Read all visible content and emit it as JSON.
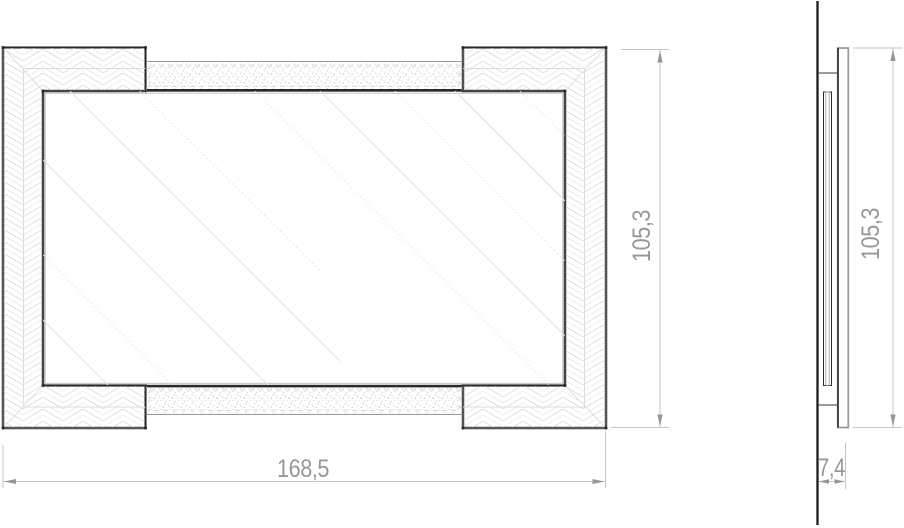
{
  "drawing": {
    "type": "technical-drawing",
    "subject": "framed-mirror",
    "views": {
      "front": {
        "label": "front-elevation",
        "width_dim": "168,5",
        "height_dim": "105,3"
      },
      "side": {
        "label": "side-profile",
        "height_dim": "105,3",
        "depth_dim": "7,4"
      }
    }
  },
  "colors": {
    "outline": "#2a2a2e",
    "soft_edge": "#9b9b9f",
    "hatch": "#d8d8dc",
    "stipple": "#b4b4b8",
    "seam": "#dcdce0",
    "mirror_reflection": "#e3e3e7",
    "dim_line": "#c6c6ca",
    "dim_arrow": "#96969a",
    "dim_text": "#97979b",
    "wall": "#1c1c20",
    "paper": "#ffffff"
  }
}
